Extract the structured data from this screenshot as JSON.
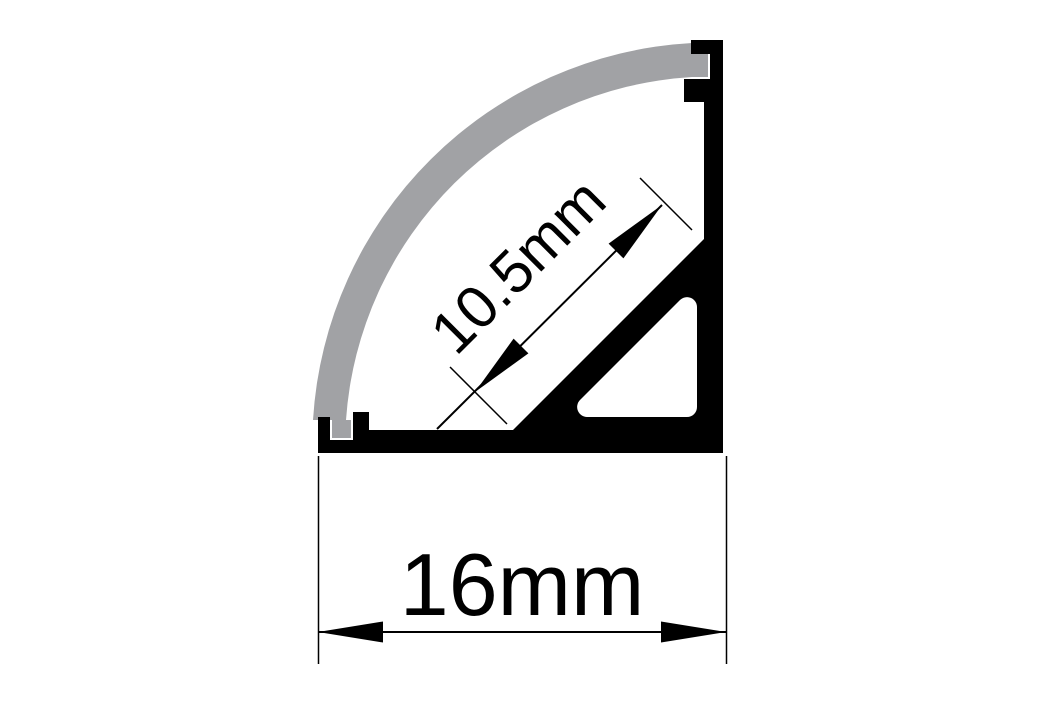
{
  "diagram": {
    "title": "LED aluminium corner profile cross-section drawing",
    "type": "technical-drawing",
    "background_color": "#ffffff",
    "profile_color": "#000000",
    "diffuser_color": "#a1a2a5",
    "line_color": "#000000",
    "parts": [
      {
        "id": "diffuser-cover",
        "description": "curved opal diffuser cover (quarter circle) clipped into notches"
      },
      {
        "id": "profile-body",
        "description": "black anodized aluminium corner channel body"
      },
      {
        "id": "led-platform",
        "description": "45-degree internal mounting platform with hollow triangular rib"
      }
    ],
    "dimensions": [
      {
        "id": "platform-width",
        "label": "10.5mm",
        "value_mm": 10.5,
        "orientation": "diagonal-45deg"
      },
      {
        "id": "base-width",
        "label": "16mm",
        "value_mm": 16,
        "orientation": "horizontal"
      }
    ]
  }
}
